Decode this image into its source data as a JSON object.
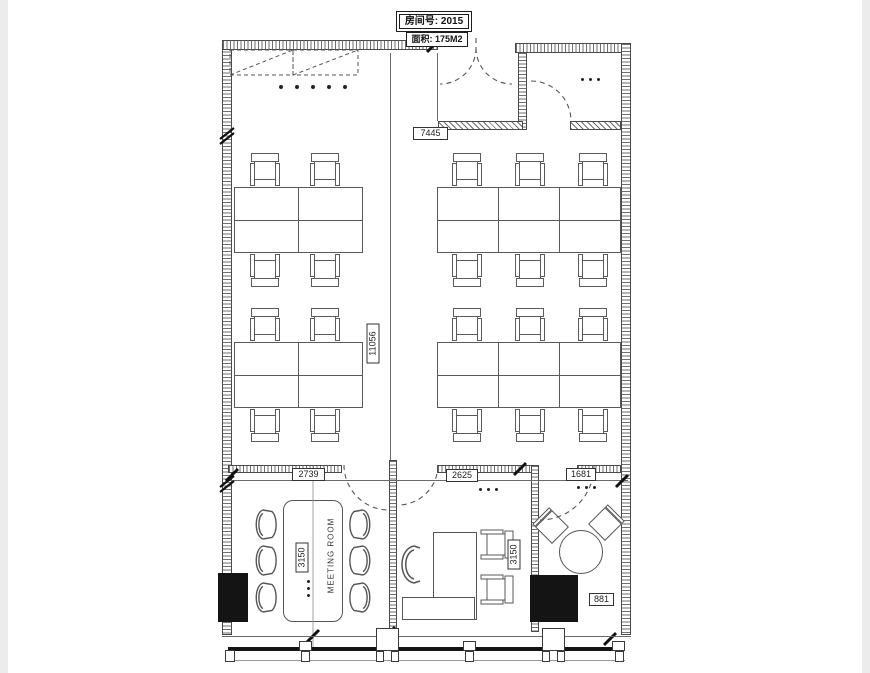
{
  "palette": {
    "line": "#4a4a4a",
    "fill": "#141414",
    "bg": "#ffffff"
  },
  "header": {
    "room_no": "房间号: 2015",
    "area": "面积: 175M2"
  },
  "dimensions": {
    "top_wall": "7445",
    "depth_total": "11056",
    "meeting_width": "2739",
    "office_width": "2625",
    "lounge_width": "1681",
    "meeting_depth": "3150",
    "office_depth": "3150",
    "lounge_column": "881"
  },
  "rooms": {
    "meeting_room": "MEETING ROOM"
  }
}
